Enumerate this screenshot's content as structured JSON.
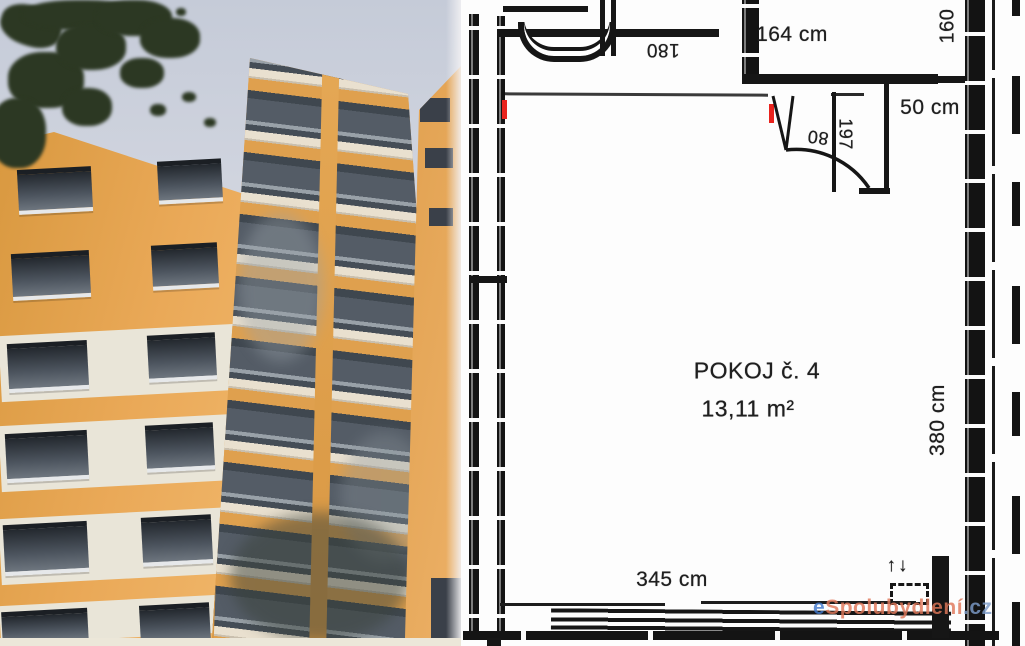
{
  "floor_plan": {
    "room": {
      "name": "POKOJ č. 4",
      "area": "13,11 m²"
    },
    "dimensions": {
      "top_width": "164 cm",
      "closet_depth": "50 cm",
      "room_depth": "380 cm",
      "room_width": "345 cm",
      "fixture_width": "180",
      "door_width": "80",
      "door_height": "197",
      "side_width": "160"
    },
    "radiator_arrows": "↑↓",
    "watermark": {
      "prefix": "e",
      "name": "Spolubydlení",
      "tld": ".cz"
    },
    "colors": {
      "line": "#161616",
      "marker_red": "#e9231d",
      "watermark_blue": "#4379cc",
      "watermark_orange": "#e0785a"
    }
  },
  "photo": {
    "colors": {
      "facade_orange": "#e5a454",
      "sky_grey_blue": "#ccd2de",
      "balcony_glass": "#4a525b",
      "panel_cream": "#e9e4d7",
      "foliage_green": "#2c3823"
    }
  }
}
